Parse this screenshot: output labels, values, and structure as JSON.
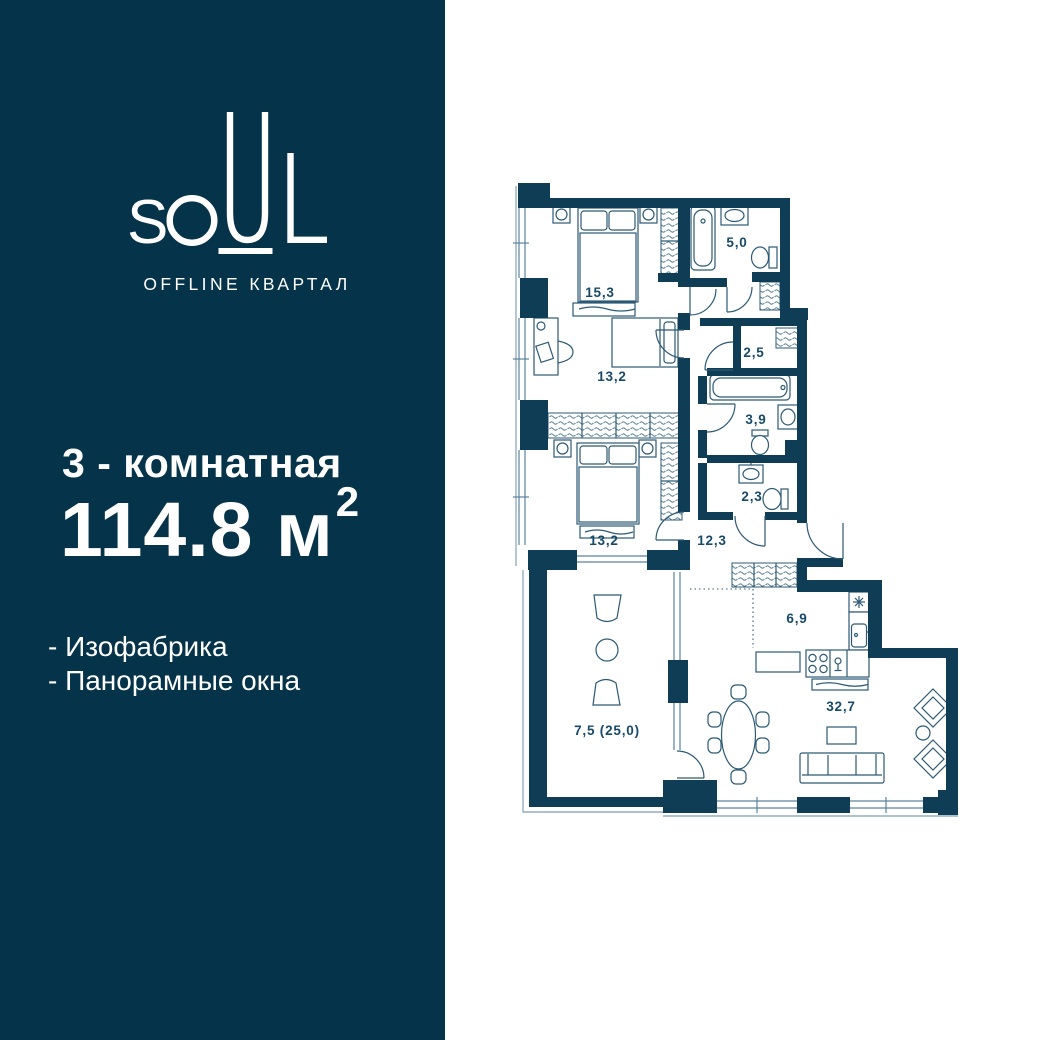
{
  "brand": {
    "name": "SOUL",
    "letters": [
      "S",
      "O",
      "U",
      "L"
    ],
    "subtitle": "OFFLINE КВАРТАЛ"
  },
  "listing": {
    "rooms_title": "3 - комнатная",
    "area_text": "114.8 м",
    "area_sup": "2",
    "features": [
      "- Изофабрика",
      "- Панорамные окна"
    ]
  },
  "floor_plan": {
    "rooms": [
      {
        "area": "15,3"
      },
      {
        "area": "5,0"
      },
      {
        "area": "13,2"
      },
      {
        "area": "2,5"
      },
      {
        "area": "3,9"
      },
      {
        "area": "2,3"
      },
      {
        "area": "13,2"
      },
      {
        "area": "12,3"
      },
      {
        "area": "6,9"
      },
      {
        "area": "7,5 (25,0)"
      },
      {
        "area": "32,7"
      }
    ]
  },
  "colors": {
    "sidebar_bg": "#053349",
    "wall": "#0f3d56",
    "line": "#2c5a75",
    "window": "#5a84a0",
    "label": "#174a68",
    "text": "#ffffff"
  }
}
